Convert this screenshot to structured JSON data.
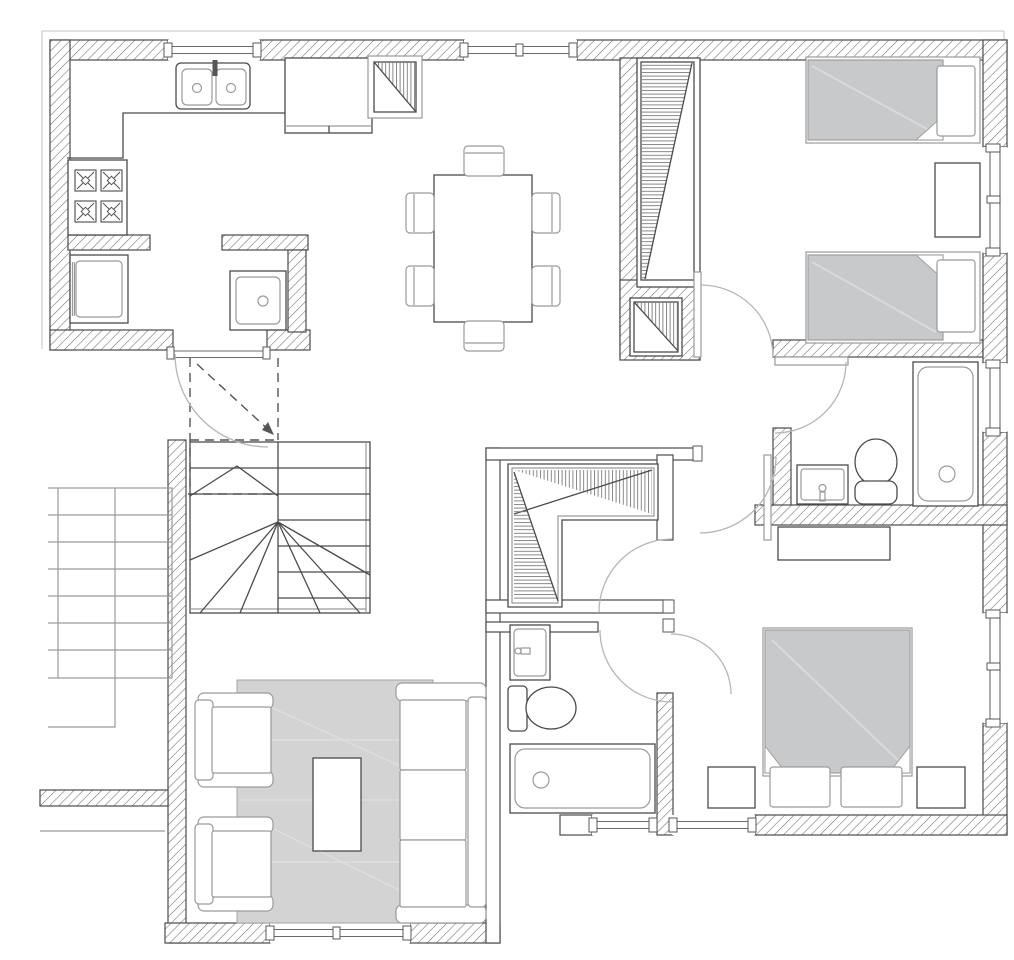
{
  "title": "Apartment floor plan (architectural drawing, no text labels)",
  "colors": {
    "line": "#4b4b4b",
    "line_light": "#9a9a9a",
    "hatch": "#6f6f6f",
    "furniture_gray": "#c7c9ca",
    "rug_gray": "#d3d3d3",
    "arc": "#b6b6b6",
    "background": "#ffffff"
  },
  "rooms": [
    {
      "name": "Kitchen",
      "fixtures": [
        "double-basin sink",
        "cooktop with 4 burners",
        "counter",
        "cabinet",
        "refrigerator",
        "washing machine",
        "utility sink"
      ]
    },
    {
      "name": "Dining area",
      "fixtures": [
        "dining table",
        "6 chairs"
      ]
    },
    {
      "name": "Twin bedroom",
      "fixtures": [
        "single bed 1",
        "single bed 2",
        "nightstand",
        "tall wardrobe",
        "small closet"
      ]
    },
    {
      "name": "Upper bathroom",
      "fixtures": [
        "washbasin",
        "toilet",
        "bathtub"
      ]
    },
    {
      "name": "Master bedroom",
      "fixtures": [
        "double bed",
        "2 pillows",
        "2 nightstands",
        "dresser"
      ]
    },
    {
      "name": "Lower bathroom",
      "fixtures": [
        "washbasin",
        "toilet",
        "bathtub"
      ]
    },
    {
      "name": "Walk-in closet",
      "fixtures": [
        "L-shaped wardrobe"
      ]
    },
    {
      "name": "Living room",
      "fixtures": [
        "armchair 1",
        "armchair 2",
        "sofa",
        "coffee table",
        "rug"
      ]
    },
    {
      "name": "Stair hall",
      "fixtures": [
        "winder staircase",
        "entry door",
        "dashed headroom lines"
      ]
    },
    {
      "name": "Exterior stair",
      "fixtures": [
        "7 treads"
      ]
    }
  ],
  "counts": {
    "windows": 8,
    "door_swings": 7,
    "stove_burners": 4,
    "dining_chairs": 6
  }
}
